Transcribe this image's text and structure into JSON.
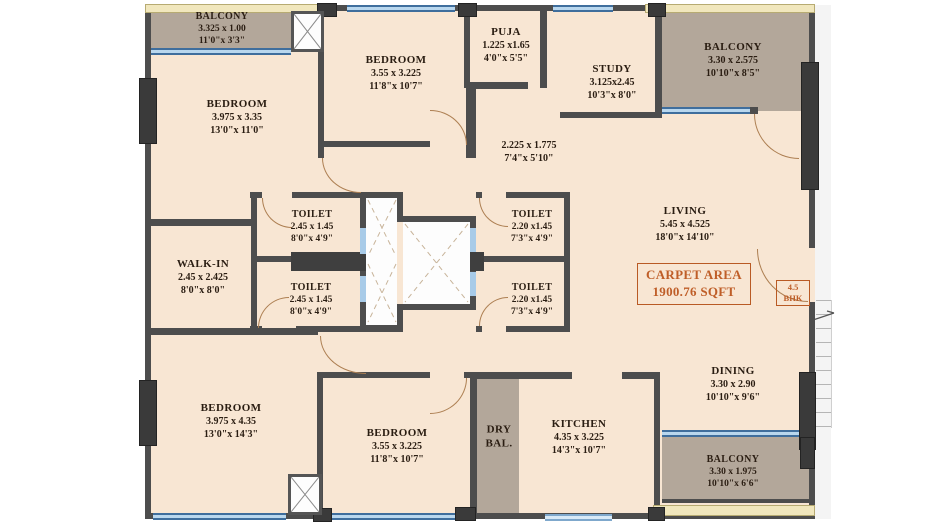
{
  "plan": {
    "badge_bhk": {
      "line1": "4.5",
      "line2": "BHK"
    },
    "carpet_area": {
      "line1": "CARPET AREA",
      "line2": "1900.76 SQFT"
    },
    "rooms": {
      "balcony_tl": {
        "name": "BALCONY",
        "metric": "3.325 x 1.00",
        "imperial": "11'0\"x 3'3\""
      },
      "bedroom1": {
        "name": "BEDROOM",
        "metric": "3.975 x 3.35",
        "imperial": "13'0\"x 11'0\""
      },
      "bedroom2": {
        "name": "BEDROOM",
        "metric": "3.55 x 3.225",
        "imperial": "11'8\"x 10'7\""
      },
      "puja": {
        "name": "PUJA",
        "metric": "1.225 x1.65",
        "imperial": "4'0\"x 5'5\""
      },
      "study": {
        "name": "STUDY",
        "metric": "3.125x2.45",
        "imperial": "10'3\"x 8'0\""
      },
      "balcony_tr": {
        "name": "BALCONY",
        "metric": "3.30 x 2.575",
        "imperial": "10'10\"x 8'5\""
      },
      "passage": {
        "metric": "2.225 x 1.775",
        "imperial": "7'4\"x 5'10\""
      },
      "walkin": {
        "name": "WALK-IN",
        "metric": "2.45 x 2.425",
        "imperial": "8'0\"x 8'0\""
      },
      "toilet_ul": {
        "name": "TOILET",
        "metric": "2.45 x 1.45",
        "imperial": "8'0\"x 4'9\""
      },
      "toilet_ll": {
        "name": "TOILET",
        "metric": "2.45 x 1.45",
        "imperial": "8'0\"x 4'9\""
      },
      "toilet_ur": {
        "name": "TOILET",
        "metric": "2.20 x1.45",
        "imperial": "7'3\"x 4'9\""
      },
      "toilet_lr": {
        "name": "TOILET",
        "metric": "2.20 x1.45",
        "imperial": "7'3\"x 4'9\""
      },
      "living": {
        "name": "LIVING",
        "metric": "5.45 x 4.525",
        "imperial": "18'0\"x 14'10\""
      },
      "bedroom3": {
        "name": "BEDROOM",
        "metric": "3.975 x 4.35",
        "imperial": "13'0\"x 14'3\""
      },
      "bedroom4": {
        "name": "BEDROOM",
        "metric": "3.55 x 3.225",
        "imperial": "11'8\"x 10'7\""
      },
      "drybal": {
        "line1": "DRY",
        "line2": "BAL."
      },
      "kitchen": {
        "name": "KITCHEN",
        "metric": "4.35 x 3.225",
        "imperial": "14'3\"x 10'7\""
      },
      "dining": {
        "name": "DINING",
        "metric": "3.30 x 2.90",
        "imperial": "10'10\"x 9'6\""
      },
      "balcony_br": {
        "name": "BALCONY",
        "metric": "3.30 x 1.975",
        "imperial": "10'10\"x 6'6\""
      }
    },
    "colors": {
      "wall": "#4d4d4d",
      "room_fill": "#f8e6d3",
      "balcony_fill": "#b3a79a",
      "window_blue": "#b9d7ee",
      "exterior_yellow": "#f1e7bd",
      "accent_orange": "#bf5e28",
      "text": "#2a1d12"
    }
  }
}
